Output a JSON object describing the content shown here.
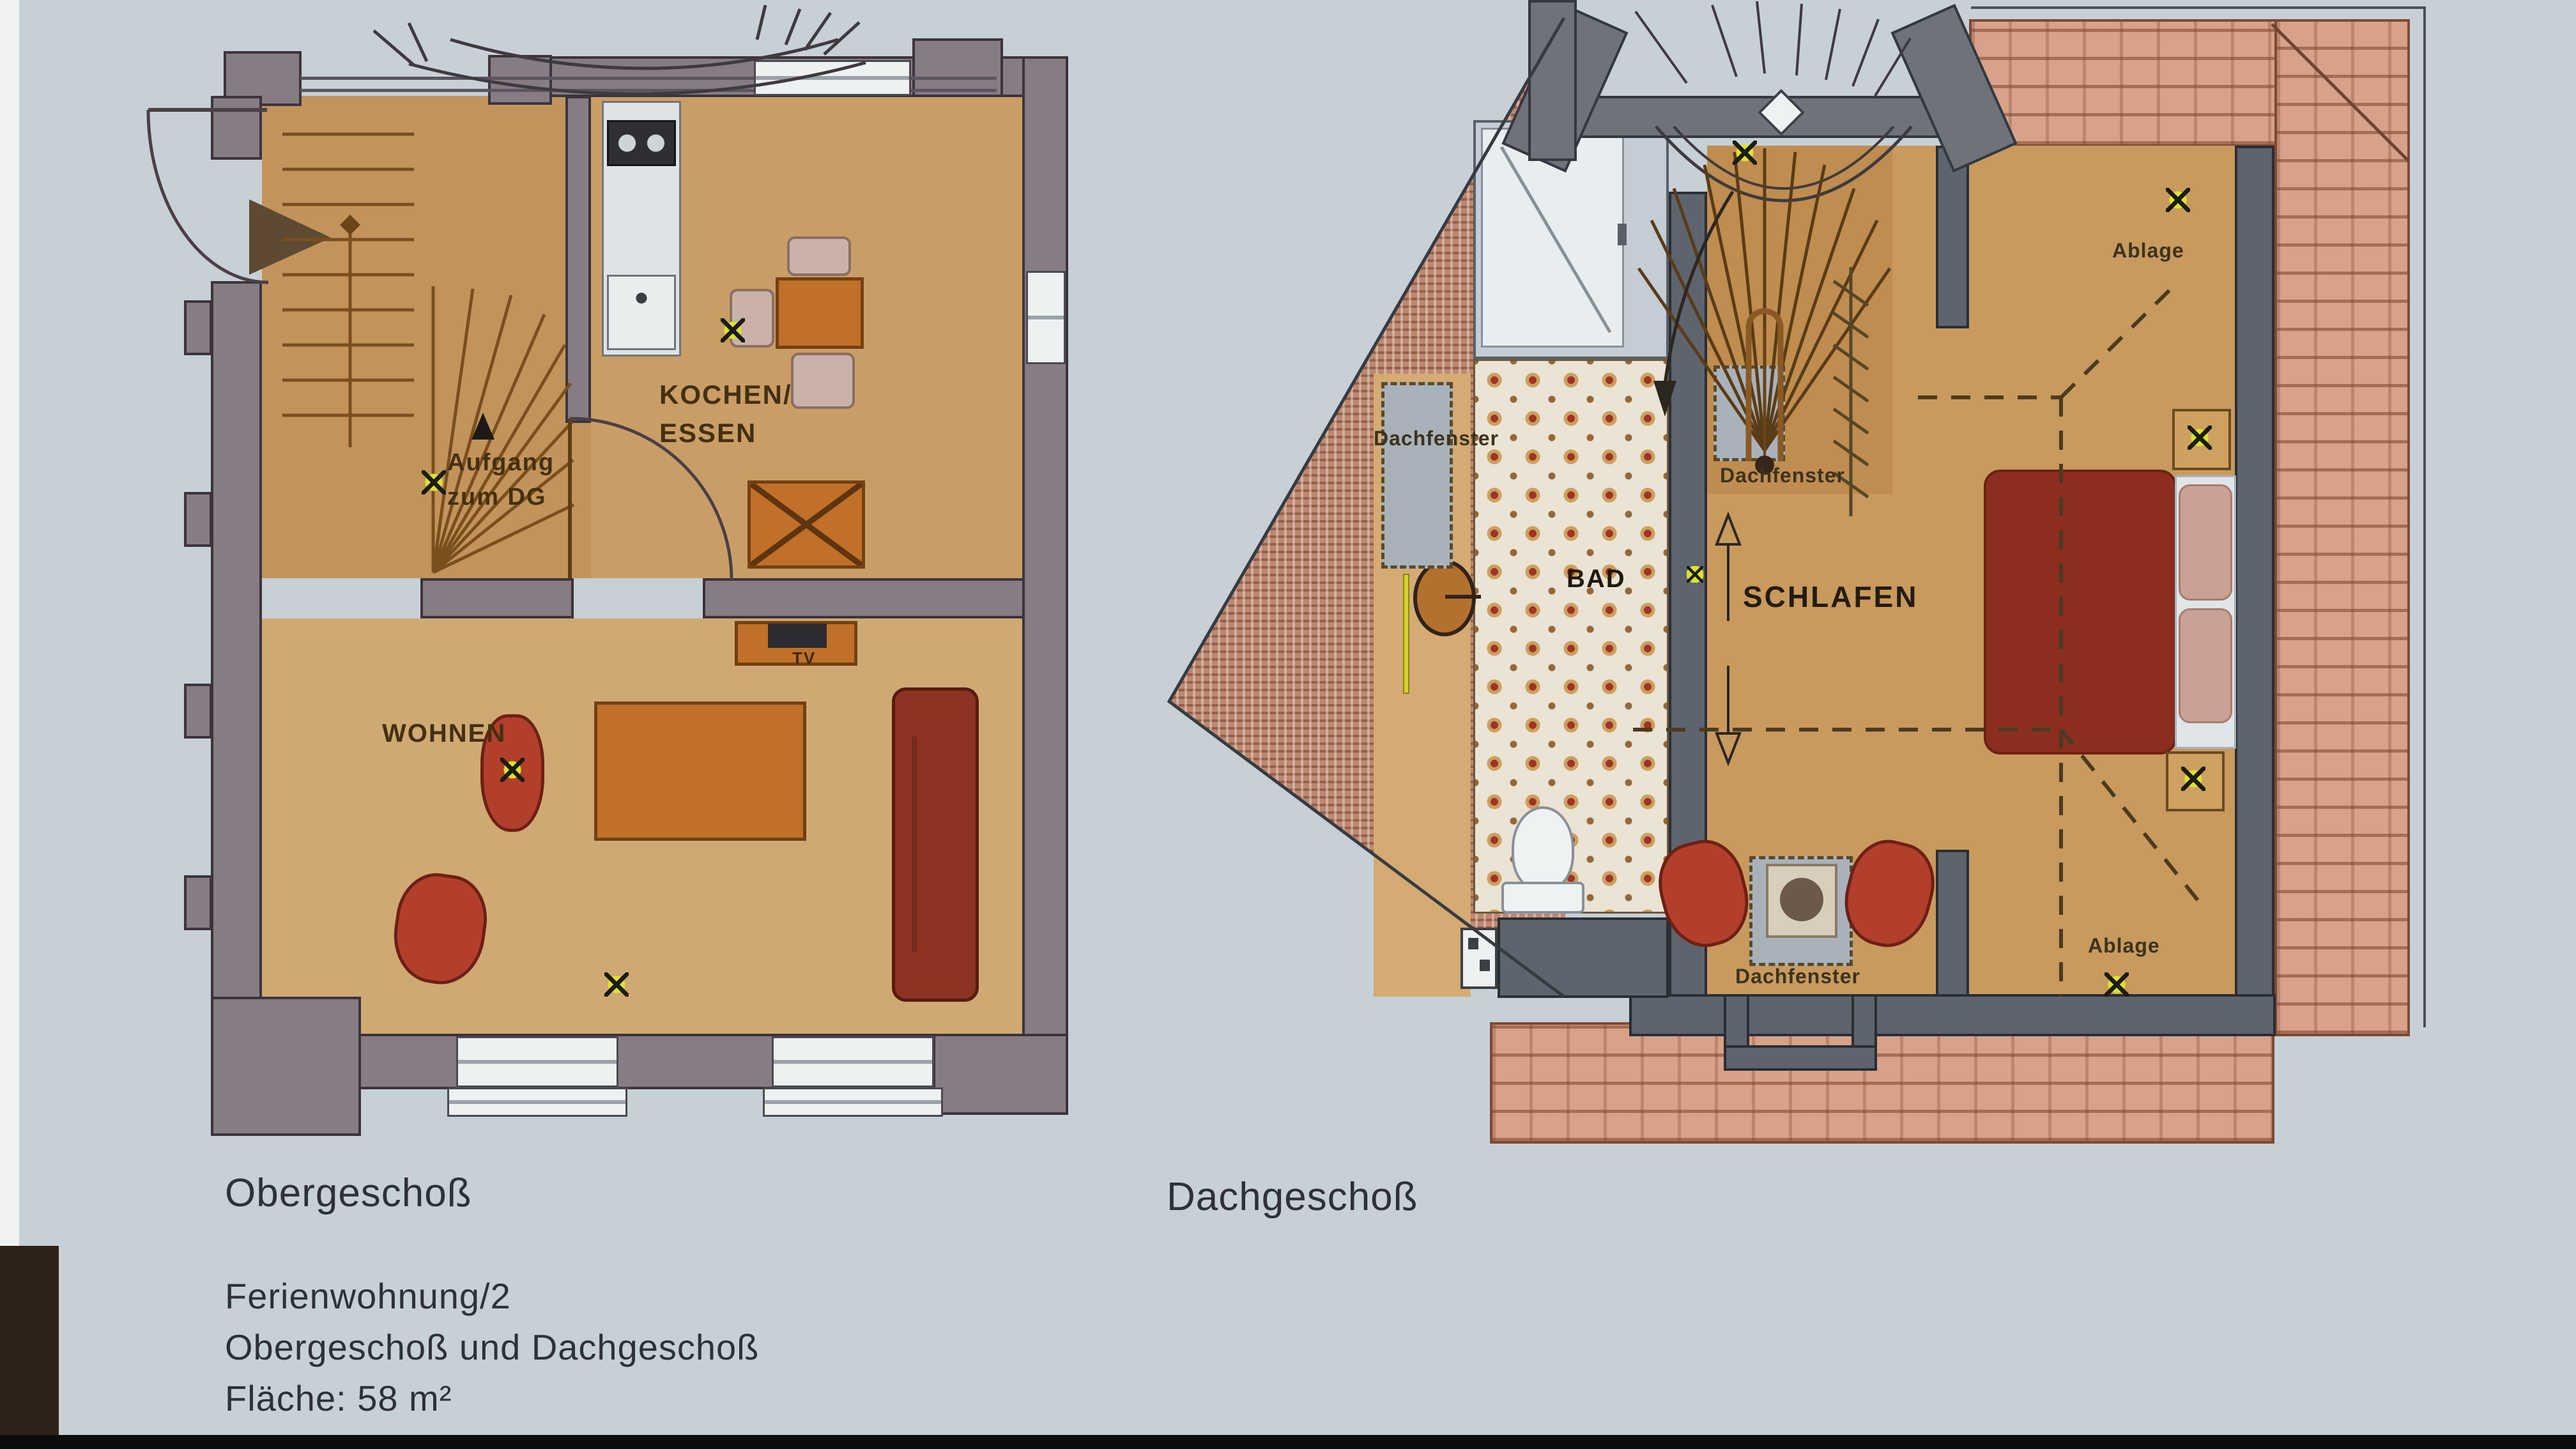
{
  "document": {
    "type": "floor-plan-photo",
    "unit_count_text": null
  },
  "captions": {
    "obergeschoss": "Obergeschoß",
    "dachgeschoss": "Dachgeschoß"
  },
  "footer": {
    "line1": "Ferienwohnung/2",
    "line2": "Obergeschoß und Dachgeschoß",
    "line3": "Fläche: 58 m²"
  },
  "labels": {
    "kochen_essen": "KOCHEN/\nESSEN",
    "aufgang_zum_dg": "Aufgang\nzum DG",
    "wohnen": "WOHNEN",
    "tv": "TV",
    "bad": "BAD",
    "schlafen": "SCHLAFEN",
    "dachfenster": "Dachfenster",
    "ablage": "Ablage"
  },
  "icons": {
    "ceiling_light_marker": "yellow-x",
    "stair_direction_arrow": "black-triangle",
    "entrance_arrow": "brown-triangle",
    "door_swing": "quarter-arc",
    "slope_arrows": "outline-up-down-arrows"
  },
  "colors": {
    "background": "#c7d0d6",
    "wall_left_plan": "#877c84",
    "wall_right_plan": "#5d646d",
    "wood_floor": "#c99e66",
    "brick_roof": "#d7a289",
    "fine_brick_bay": "#bd8872",
    "tile_accent": "#a23324",
    "furniture_red": "#b13f2c",
    "bed_red": "#8c2e1f",
    "furniture_orange": "#c07028",
    "marker_yellow": "#dce428"
  }
}
